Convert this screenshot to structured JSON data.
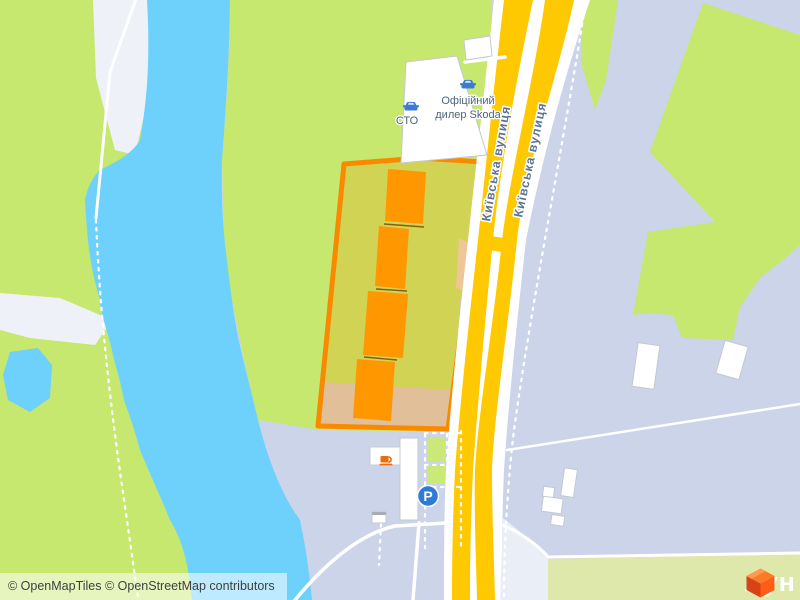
{
  "street": {
    "name": "Київська вулиця"
  },
  "poi": {
    "sto_label": "СТО",
    "dealer_line1": "Офіційний",
    "dealer_line2": "дилер Skoda",
    "parking_symbol": "P"
  },
  "attribution": {
    "text": "© OpenMapTiles © OpenStreetMap contributors"
  },
  "logo": {
    "text": "лун"
  },
  "colors": {
    "water": "#6dd1fc",
    "greenery": "#c6e86e",
    "pale_greenery": "#dfe8ab",
    "urban": "#cbd4e8",
    "road_yellow": "#fec900",
    "site_outline": "#f98a00",
    "site_building": "#ff9800",
    "sand": "#eef2f8",
    "parking_blue": "#2e7cd6",
    "poi_icon_blue": "#3f7ad1",
    "coffee_orange": "#ee6c0a",
    "brand_orange": "#ff6d1f"
  }
}
